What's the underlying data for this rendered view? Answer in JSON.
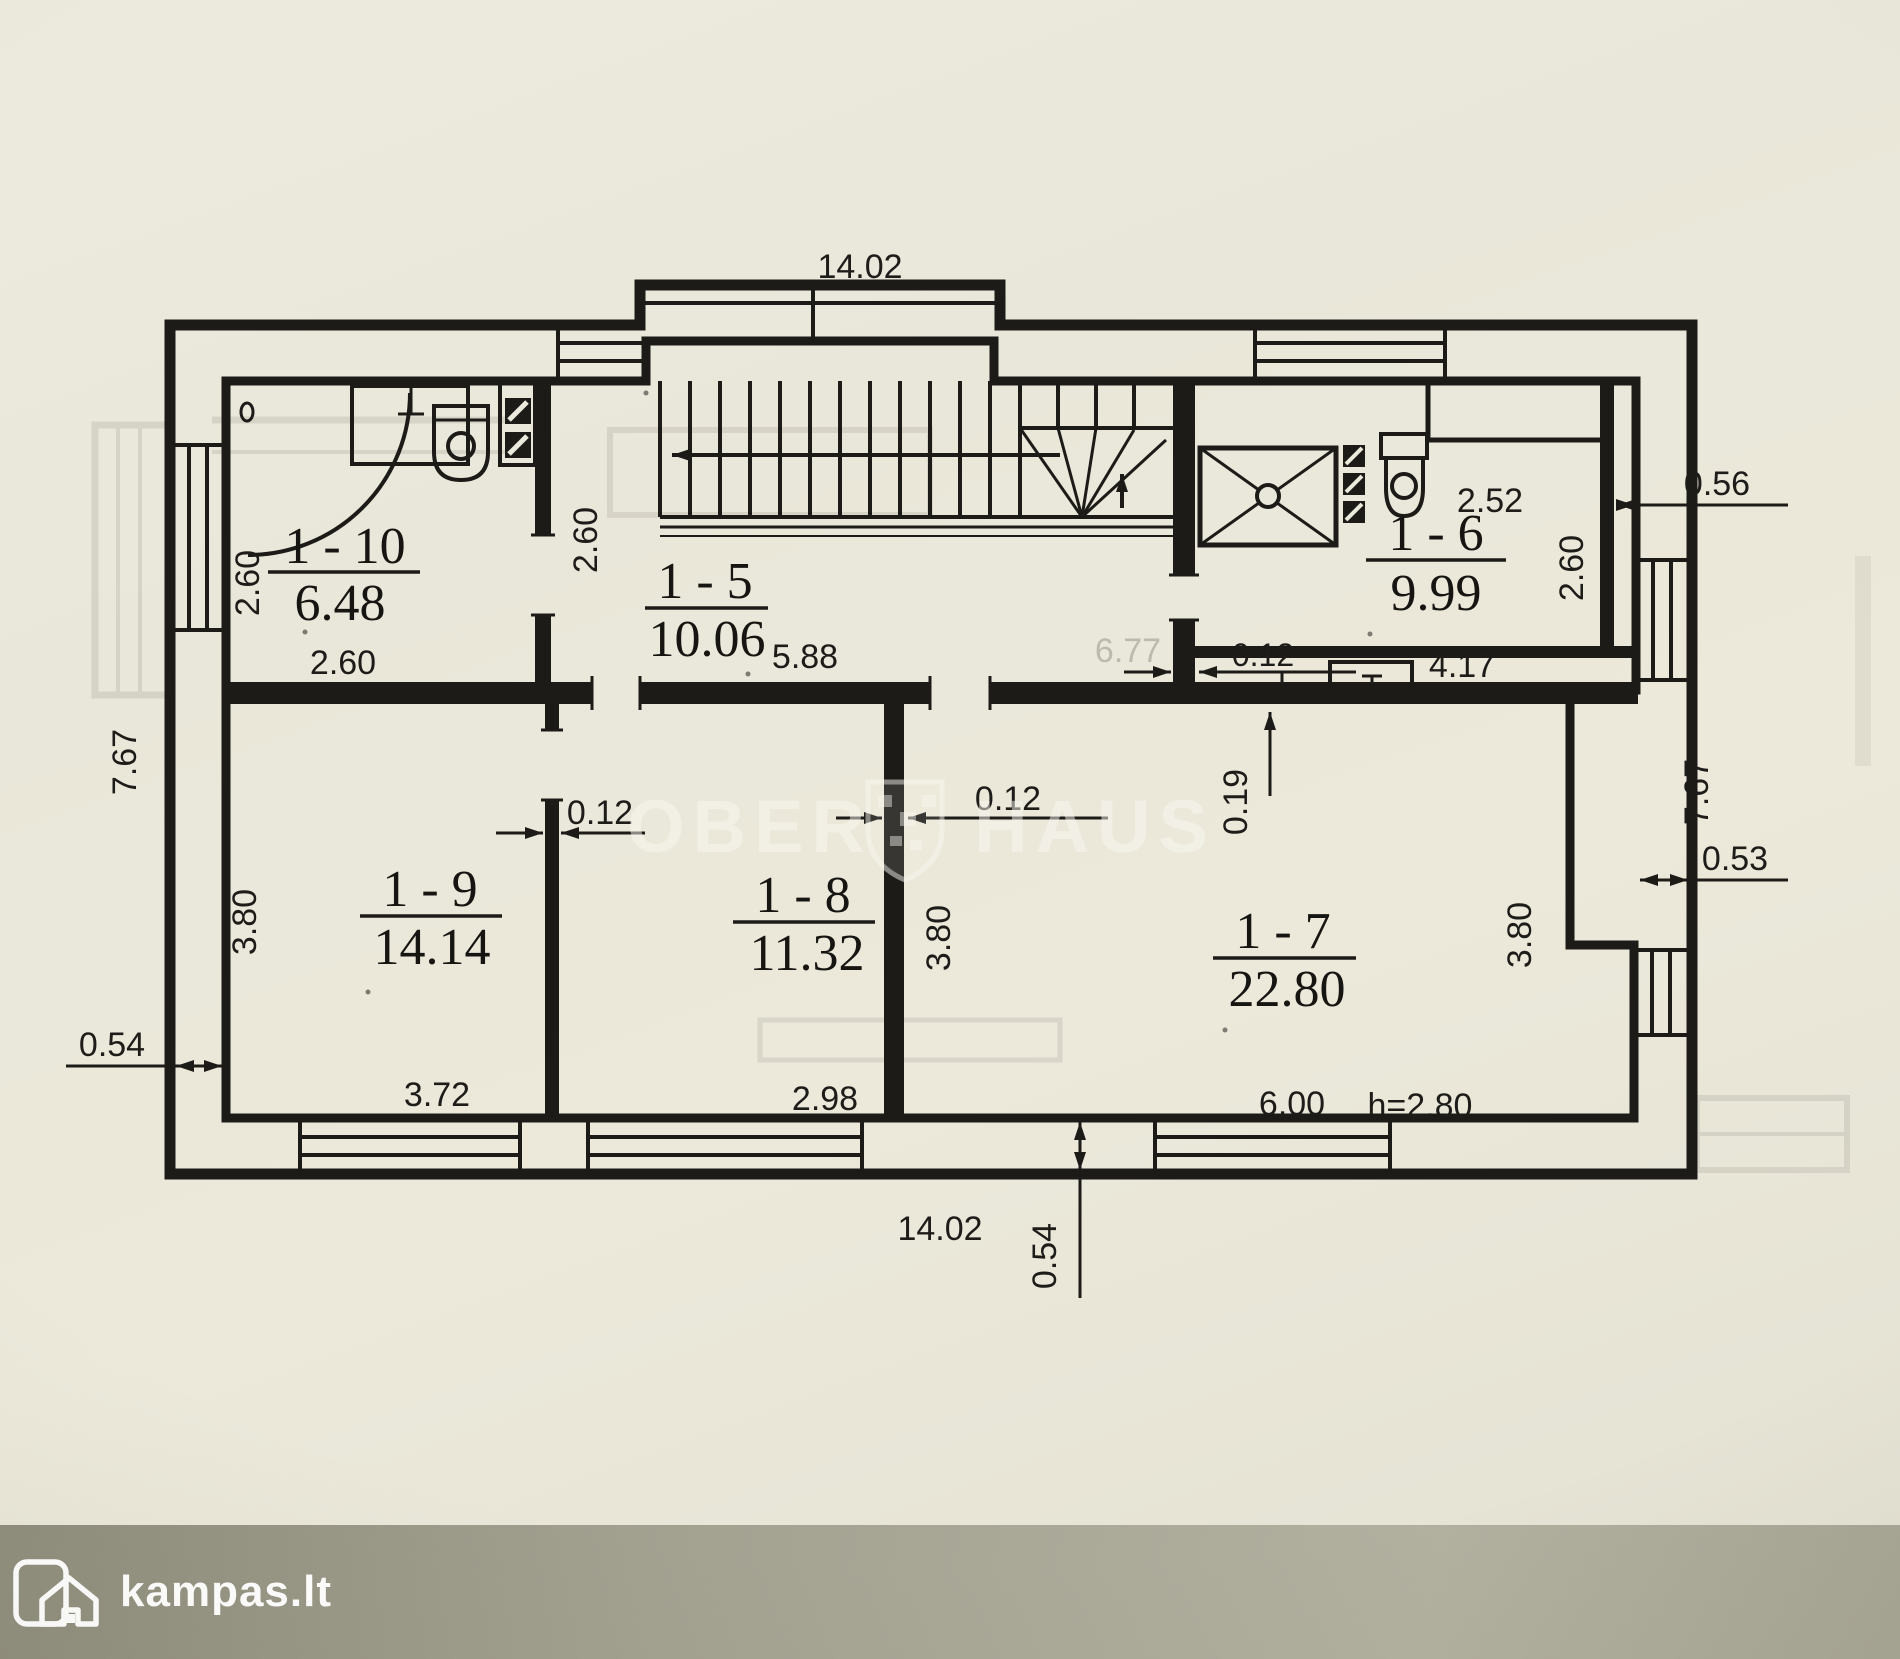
{
  "plan": {
    "rooms": [
      {
        "label": "1 - 10",
        "area": "6.48"
      },
      {
        "label": "1 - 5",
        "area": "10.06"
      },
      {
        "label": "1 - 6",
        "area": "9.99"
      },
      {
        "label": "1 - 7",
        "area": "22.80"
      },
      {
        "label": "1 - 8",
        "area": "11.32"
      },
      {
        "label": "1 - 9",
        "area": "14.14"
      }
    ],
    "dimensions": {
      "overall_width_top": "14.02",
      "overall_width_bottom": "14.02",
      "overall_height_left": "7.67",
      "overall_height_right": "7.67",
      "room110_height": "2.60",
      "room110_width": "2.60",
      "hall_height": "2.60",
      "hall_width": "5.88",
      "room16_top": "2.52",
      "room16_right_height": "2.60",
      "room16_width": "4.17",
      "room19_height": "3.80",
      "room19_width": "3.72",
      "room18_width": "2.98",
      "room17_left_height": "3.80",
      "room17_right_height": "3.80",
      "room17_width": "6.00",
      "ceiling_height": "h=2.80",
      "partition_left": "0.12",
      "partition_middle": "0.12",
      "partition_right": "0.12",
      "wall_019": "0.19",
      "wall_left": "0.54",
      "wall_bottom": "0.54",
      "wall_right": "0.53",
      "wall_offset_top_right": "0.56",
      "bleedthrough_value": "6.77"
    }
  },
  "watermark": {
    "left": "OBER",
    "right": "HAUS"
  },
  "footer": {
    "logo_text": "kampas.lt"
  }
}
